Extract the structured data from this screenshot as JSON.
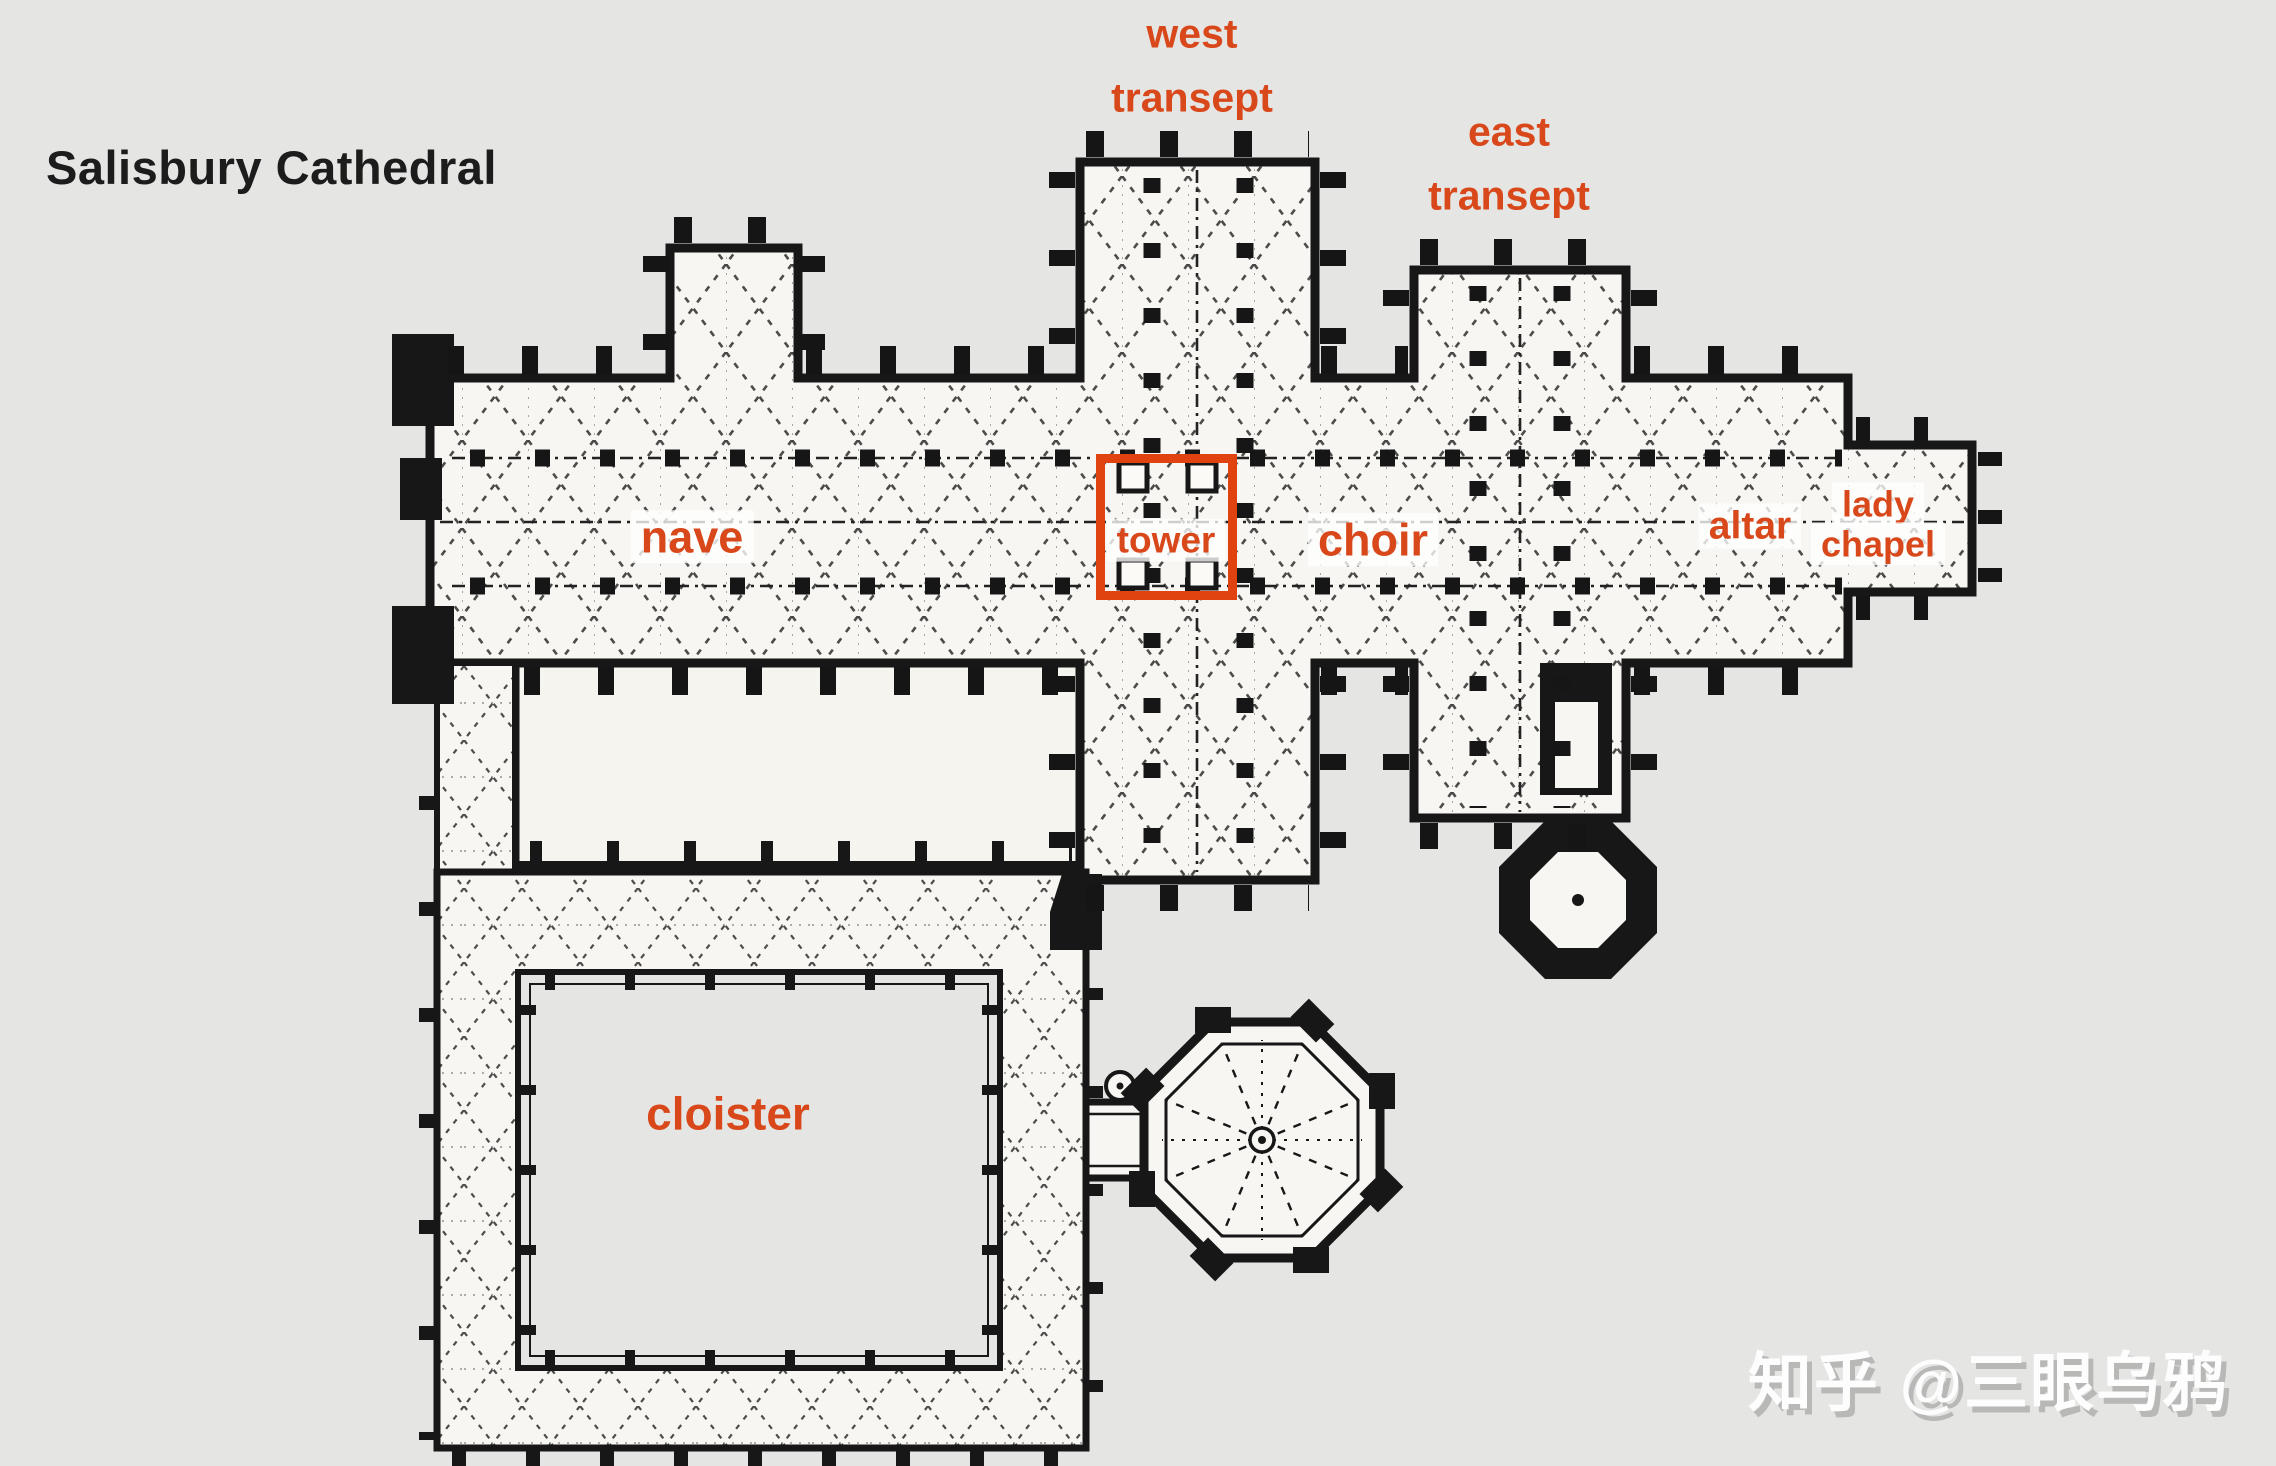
{
  "title": "Salisbury Cathedral",
  "watermark": "知乎 @三眼乌鸦",
  "colors": {
    "background": "#e5e5e4",
    "paper": "#f7f6f2",
    "ink": "#171717",
    "label_orange": "#d9481b",
    "tower_box_red": "#e0430f"
  },
  "labels": {
    "west_transept": {
      "line1": "west",
      "line2": "transept"
    },
    "east_transept": {
      "line1": "east",
      "line2": "transept"
    },
    "nave": "nave",
    "tower": "tower",
    "choir": "choir",
    "altar": "altar",
    "lady_chapel": {
      "line1": "lady",
      "line2": "chapel"
    },
    "cloister": "cloister"
  },
  "diagram": {
    "type": "floor-plan",
    "building": "Salisbury Cathedral",
    "labeled_parts": [
      "west transept",
      "east transept",
      "nave",
      "tower",
      "choir",
      "altar",
      "lady chapel",
      "cloister"
    ],
    "unlabeled_parts": [
      "north porch",
      "chapter house (octagon)",
      "treasury (small octagon)",
      "cloister garth"
    ]
  }
}
